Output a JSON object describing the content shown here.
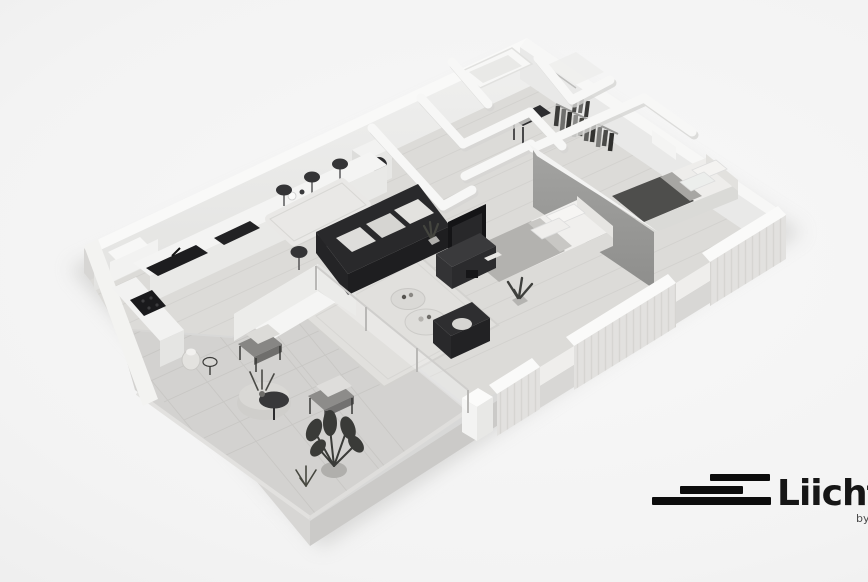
{
  "brand": {
    "name": "Liicht",
    "byline": "by",
    "icon": "stacked-bars-logo-icon",
    "text_color": "#161616",
    "bar_color": "#0c0c0c"
  },
  "scene": {
    "style": "monochrome-3d-isometric-floorplan-render",
    "palette": {
      "background_center": "#f8f8f8",
      "background_edge": "#e9e9e9",
      "wall_white": "#f8f8f7",
      "wall_inner": "#e9e9e8",
      "floor_wood": "#dcdbd8",
      "floor_tile": "#d3d2d0",
      "slab_side": "#cbcac8",
      "accent_wall": "#9a9a98",
      "furniture_dark": "#29292b",
      "textile_light": "#efeeec",
      "shadow": "#bdbdbb"
    },
    "rooms": [
      "kitchen",
      "dining-area",
      "living-room",
      "laundry-room",
      "bathroom",
      "shower-room",
      "hallway",
      "walk-in-closet",
      "master-bedroom",
      "second-bedroom",
      "terrace"
    ],
    "furniture": [
      "kitchen-counter-with-sink-and-cooktop",
      "dining-table-with-six-chairs",
      "dark-sofa-with-cushions",
      "tv-panel-and-media-console",
      "round-coffee-tables",
      "dark-armchair",
      "area-rug",
      "master-double-bed",
      "second-double-bed",
      "wardrobe-with-hanging-clothes",
      "washing-machine",
      "bathtub",
      "hall-console-table",
      "outdoor-lounge-chairs",
      "outdoor-pouf-table",
      "potted-plants"
    ]
  }
}
